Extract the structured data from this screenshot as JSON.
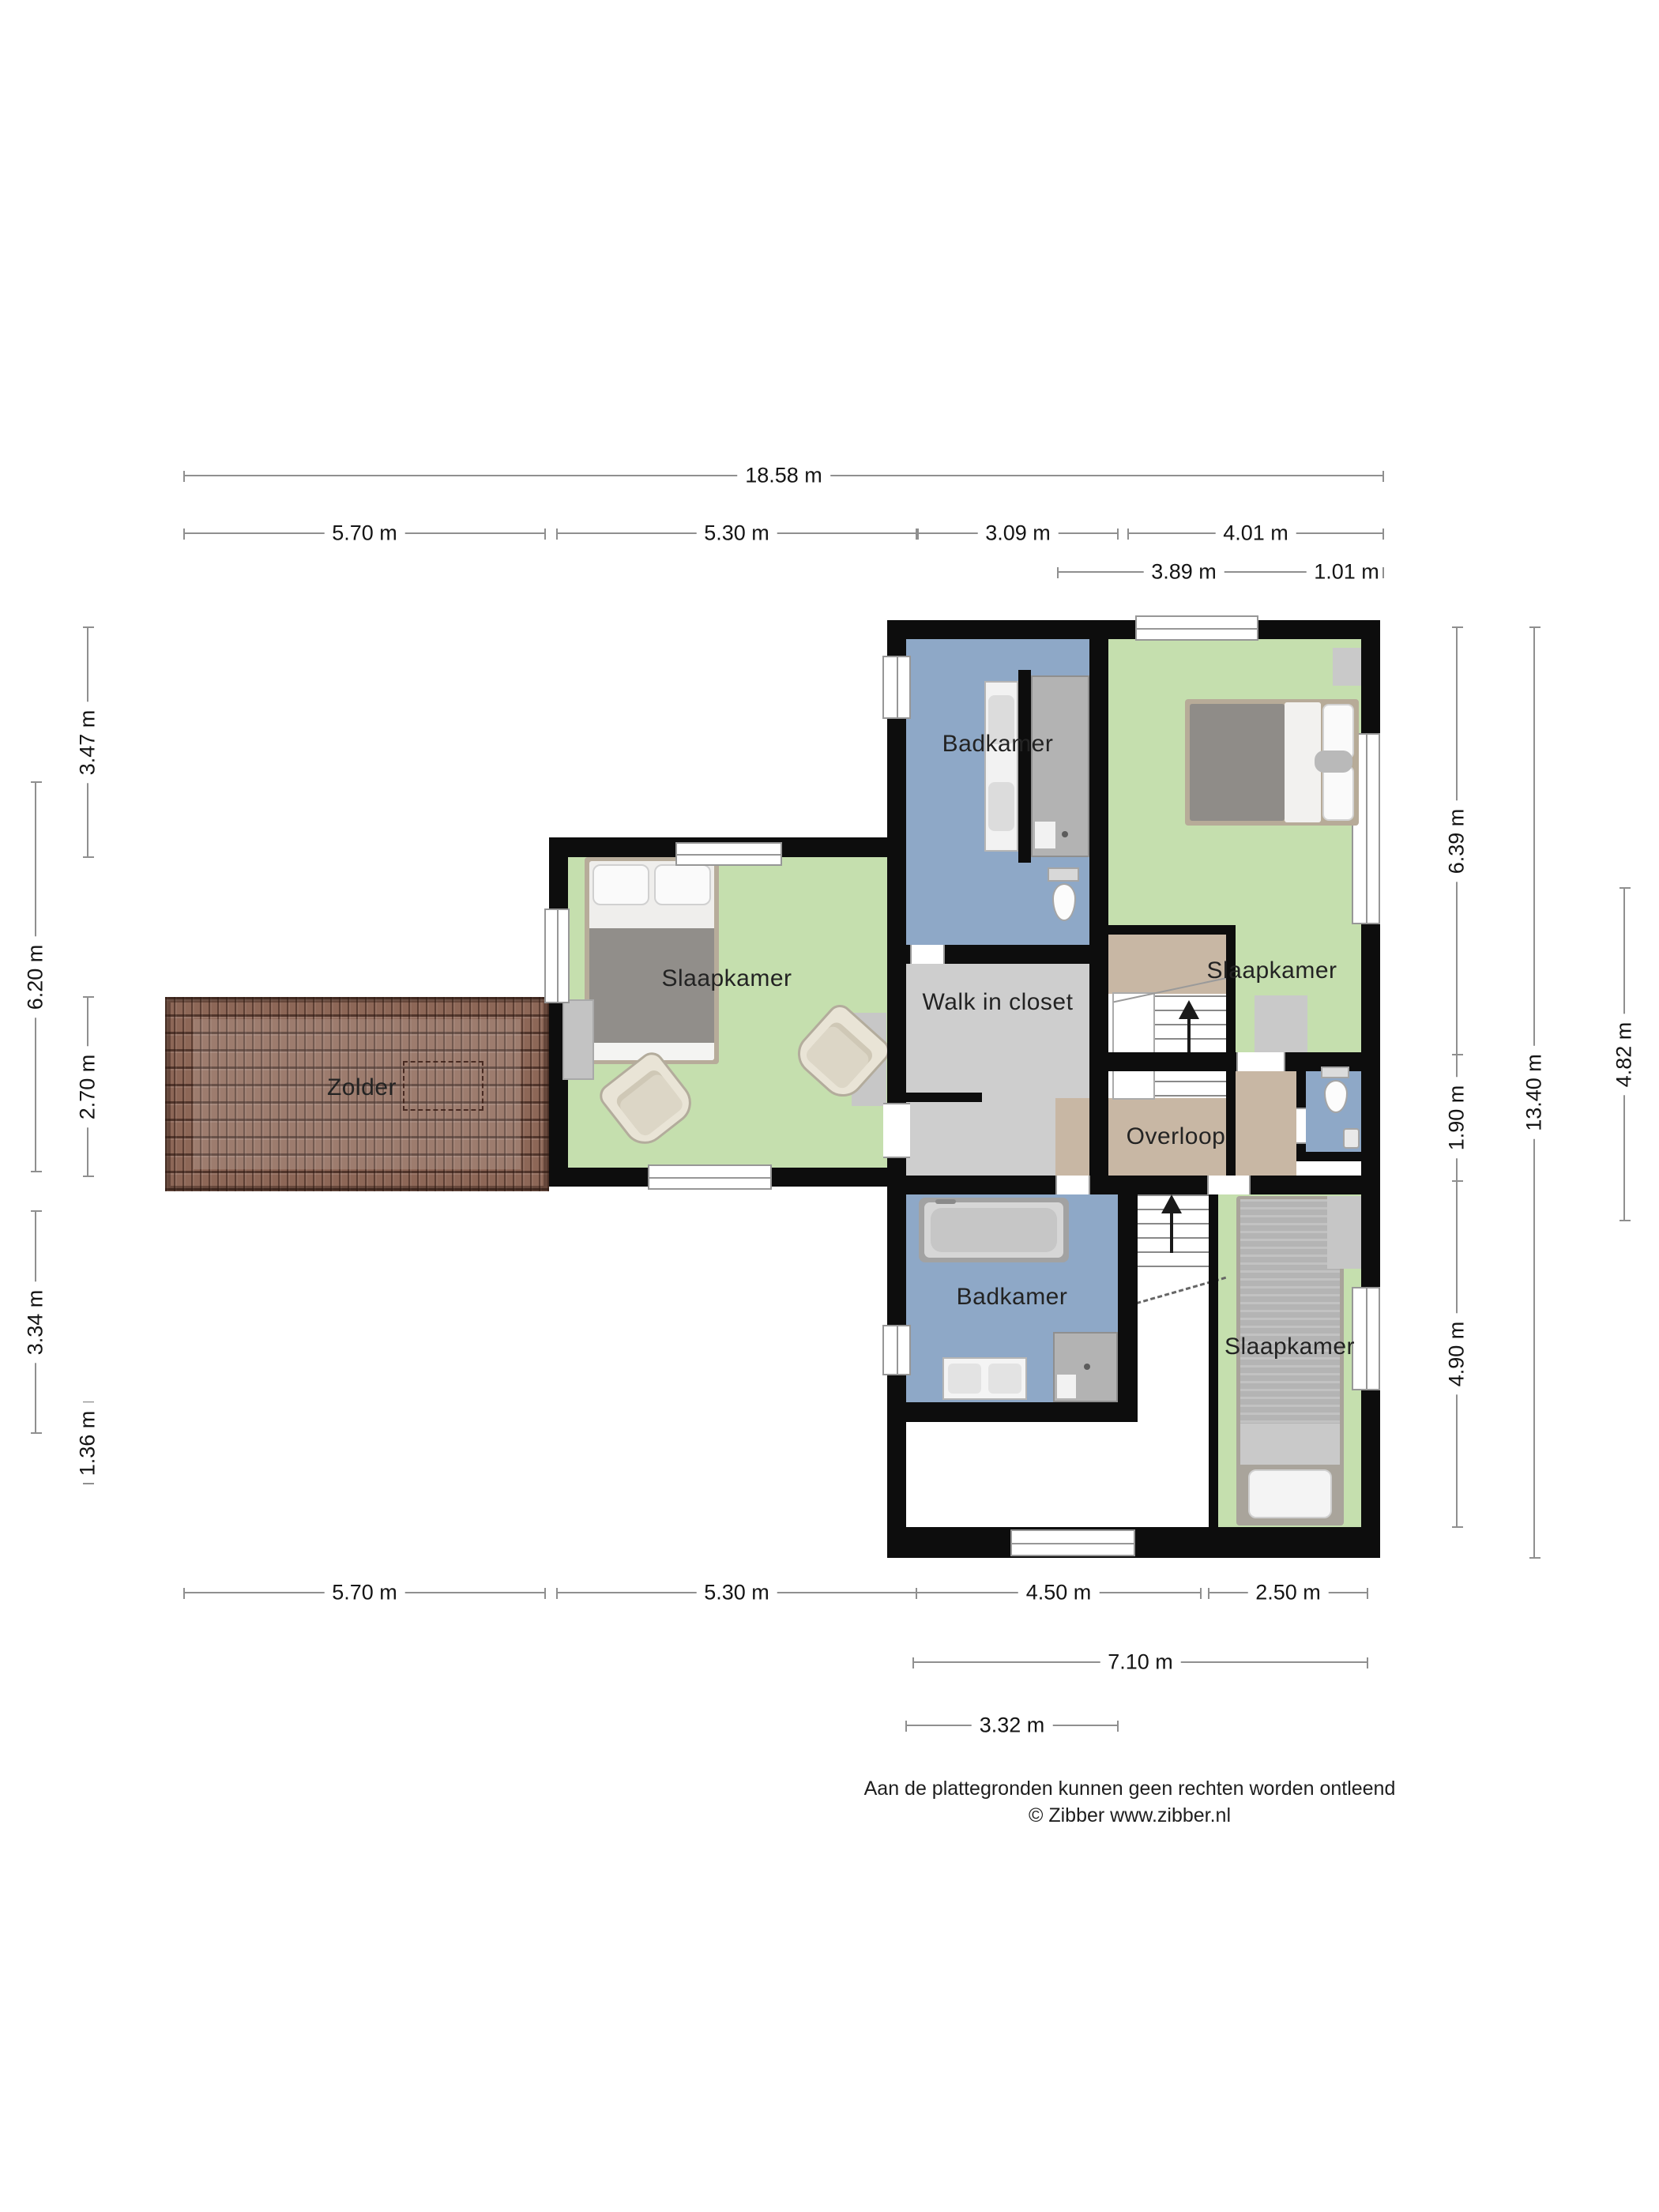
{
  "rooms": {
    "badkamer_top": {
      "label": "Badkamer"
    },
    "slaapkamer_top_right": {
      "label": "Slaapkamer"
    },
    "slaapkamer_left": {
      "label": "Slaapkamer"
    },
    "walk_in_closet": {
      "label": "Walk in closet"
    },
    "zolder": {
      "label": "Zolder"
    },
    "overloop": {
      "label": "Overloop"
    },
    "badkamer_bottom": {
      "label": "Badkamer"
    },
    "slaapkamer_bottom_right": {
      "label": "Slaapkamer"
    }
  },
  "dimensions": {
    "top_total": {
      "value": "18.58 m"
    },
    "top_segments": [
      {
        "value": "5.70 m"
      },
      {
        "value": "5.30 m"
      },
      {
        "value": "3.09 m"
      },
      {
        "value": "4.01 m"
      }
    ],
    "top_sub": [
      {
        "value": "3.89 m"
      },
      {
        "value": "1.01 m"
      }
    ],
    "left_inner": [
      {
        "value": "3.47 m"
      },
      {
        "value": "2.70 m"
      },
      {
        "value": "1.36 m"
      }
    ],
    "left_outer": [
      {
        "value": "6.20 m"
      },
      {
        "value": "3.34 m"
      }
    ],
    "right_col1": [
      {
        "value": "6.39 m"
      },
      {
        "value": "1.90 m"
      },
      {
        "value": "4.90 m"
      }
    ],
    "right_total": {
      "value": "13.40 m"
    },
    "right_sub": {
      "value": "4.82 m"
    },
    "bottom_segments": [
      {
        "value": "5.70 m"
      },
      {
        "value": "5.30 m"
      },
      {
        "value": "4.50 m"
      },
      {
        "value": "2.50 m"
      }
    ],
    "bottom_sub1": {
      "value": "7.10 m"
    },
    "bottom_sub2": {
      "value": "3.32 m"
    }
  },
  "footer": {
    "line1": "Aan de plattegronden kunnen geen rechten worden ontleend",
    "line2": "© Zibber www.zibber.nl"
  },
  "colors": {
    "wall": "#0d0d0d",
    "bedroom_green": "#c5dfae",
    "bathroom_blue": "#8ea8c7",
    "closet_gray": "#cecece",
    "hall_tan": "#c8b7a4",
    "roof_brown": "#8d6757",
    "dimension_line": "#8f8f8f",
    "label_text": "#232323"
  }
}
